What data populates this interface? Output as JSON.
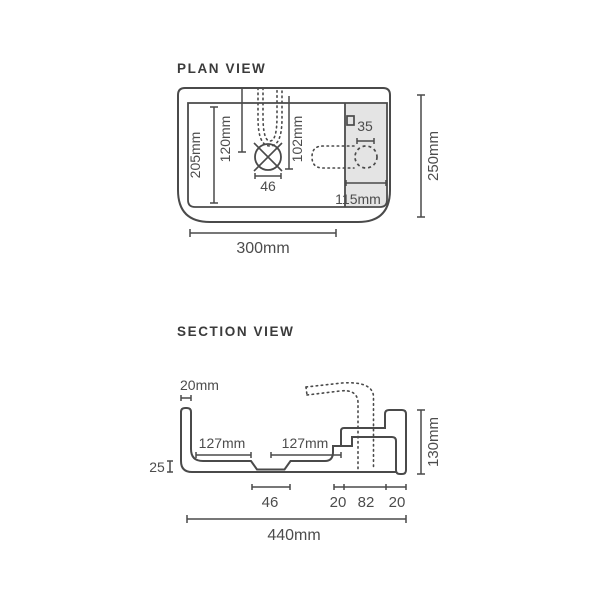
{
  "colors": {
    "line": "#4a4a4a",
    "shade": "#e4e4e4",
    "text": "#4c4c4c"
  },
  "plan": {
    "title": "PLAN VIEW",
    "bowl_depth": "205mm",
    "spout_reach": "120mm",
    "drain_offset": "102mm",
    "drain_size": "46",
    "tap_hole": "35",
    "deck_width": "115mm",
    "overall_width": "300mm",
    "overall_depth": "250mm"
  },
  "section": {
    "title": "SECTION VIEW",
    "wall_thickness": "20mm",
    "bowl_left": "127mm",
    "bowl_right": "127mm",
    "base_thickness": "25",
    "drain_width": "46",
    "step_width": "20",
    "deck_width": "82",
    "right_wall": "20",
    "overall_width": "440mm",
    "overall_height": "130mm"
  }
}
